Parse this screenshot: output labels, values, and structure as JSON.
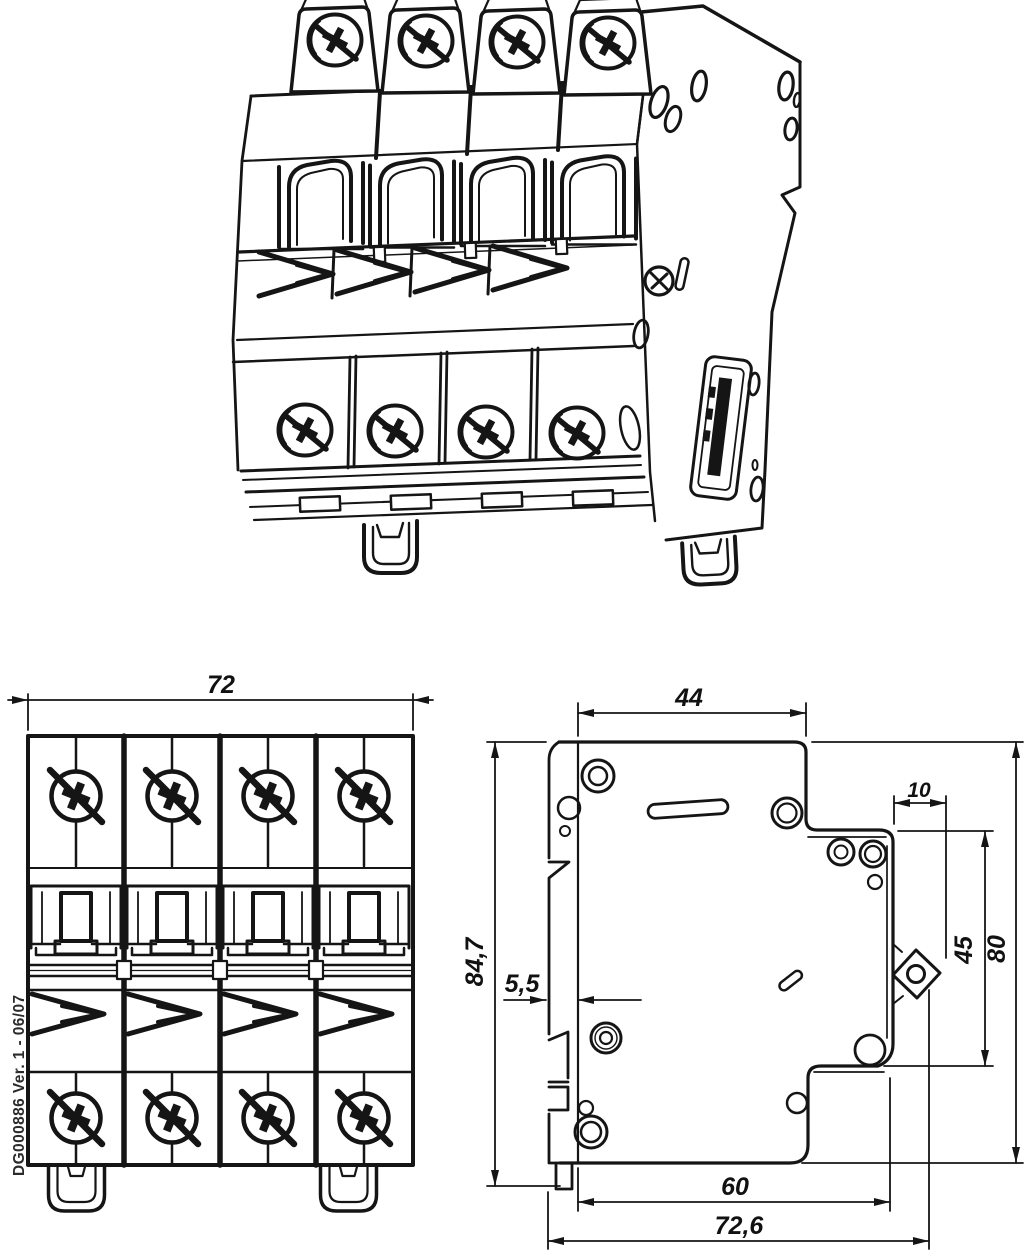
{
  "labels": {
    "document_code": "DG000886 Ver. 1 - 06/07"
  },
  "dimensions": {
    "front_width": "72",
    "top_depth": "44",
    "front_step": "10",
    "total_height": "84,7",
    "rail_plate_thickness": "5,5",
    "front_height": "45",
    "body_height": "80",
    "body_depth": "60",
    "total_depth": "72,6"
  },
  "colors": {
    "line": "#151515",
    "background": "#ffffff"
  }
}
